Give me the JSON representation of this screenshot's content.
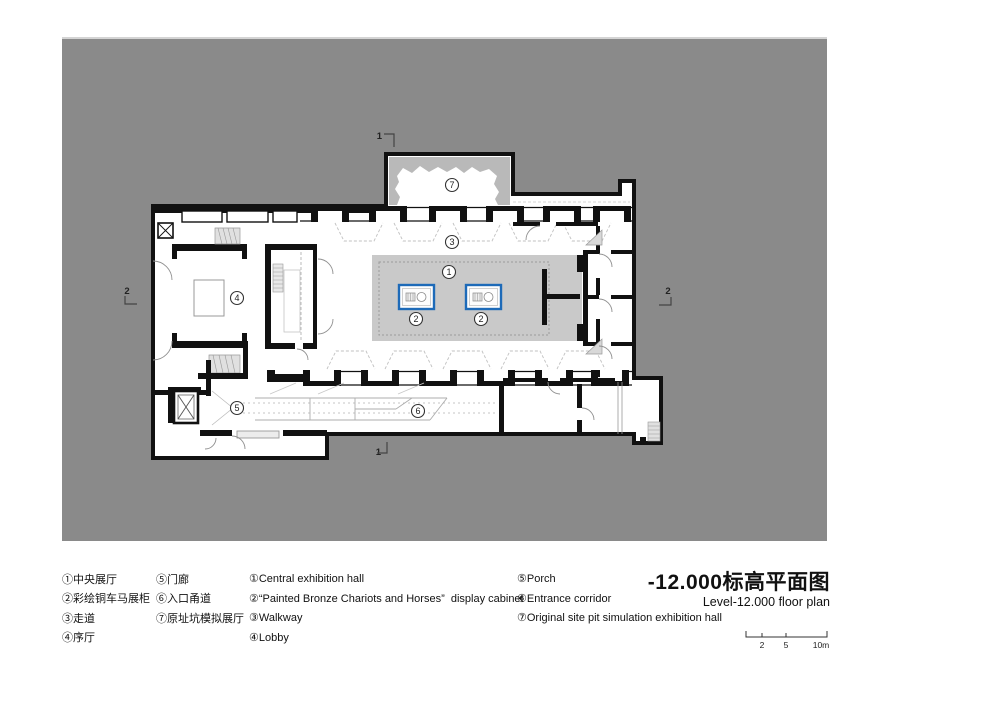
{
  "title": {
    "zh": "-12.000标高平面图",
    "en": "Level-12.000 floor plan"
  },
  "legend": {
    "zh_col1": [
      "①中央展厅",
      "②彩绘铜车马展柜",
      "③走道",
      "④序厅"
    ],
    "zh_col2": [
      "⑤门廊",
      "⑥入口甬道",
      "⑦原址坑模拟展厅"
    ],
    "en_col1": [
      "①Central exhibition hall",
      "②“Painted Bronze Chariots and Horses”  display cabinet",
      "③Walkway",
      "④Lobby"
    ],
    "en_col2": [
      "⑤Porch",
      "⑥Entrance corridor",
      "⑦Original site pit simulation exhibition hall"
    ]
  },
  "plan": {
    "room_numbers": {
      "hall": "1",
      "cabinet": "2",
      "walkway": "3",
      "lobby": "4",
      "porch": "5",
      "corridor": "6",
      "pit": "7"
    },
    "section_markers": {
      "top": "1",
      "bottom": "1",
      "left": "2",
      "right": "2"
    }
  },
  "scale_bar": {
    "l2": "2",
    "l5": "5",
    "l10": "10m"
  },
  "colors": {
    "background_gray": "#8a8a8a",
    "platform_gray": "#c9c9c9",
    "pit_gray": "#b9b9b9",
    "cabinet_blue": "#1d6ab8",
    "wall_black": "#111111"
  }
}
